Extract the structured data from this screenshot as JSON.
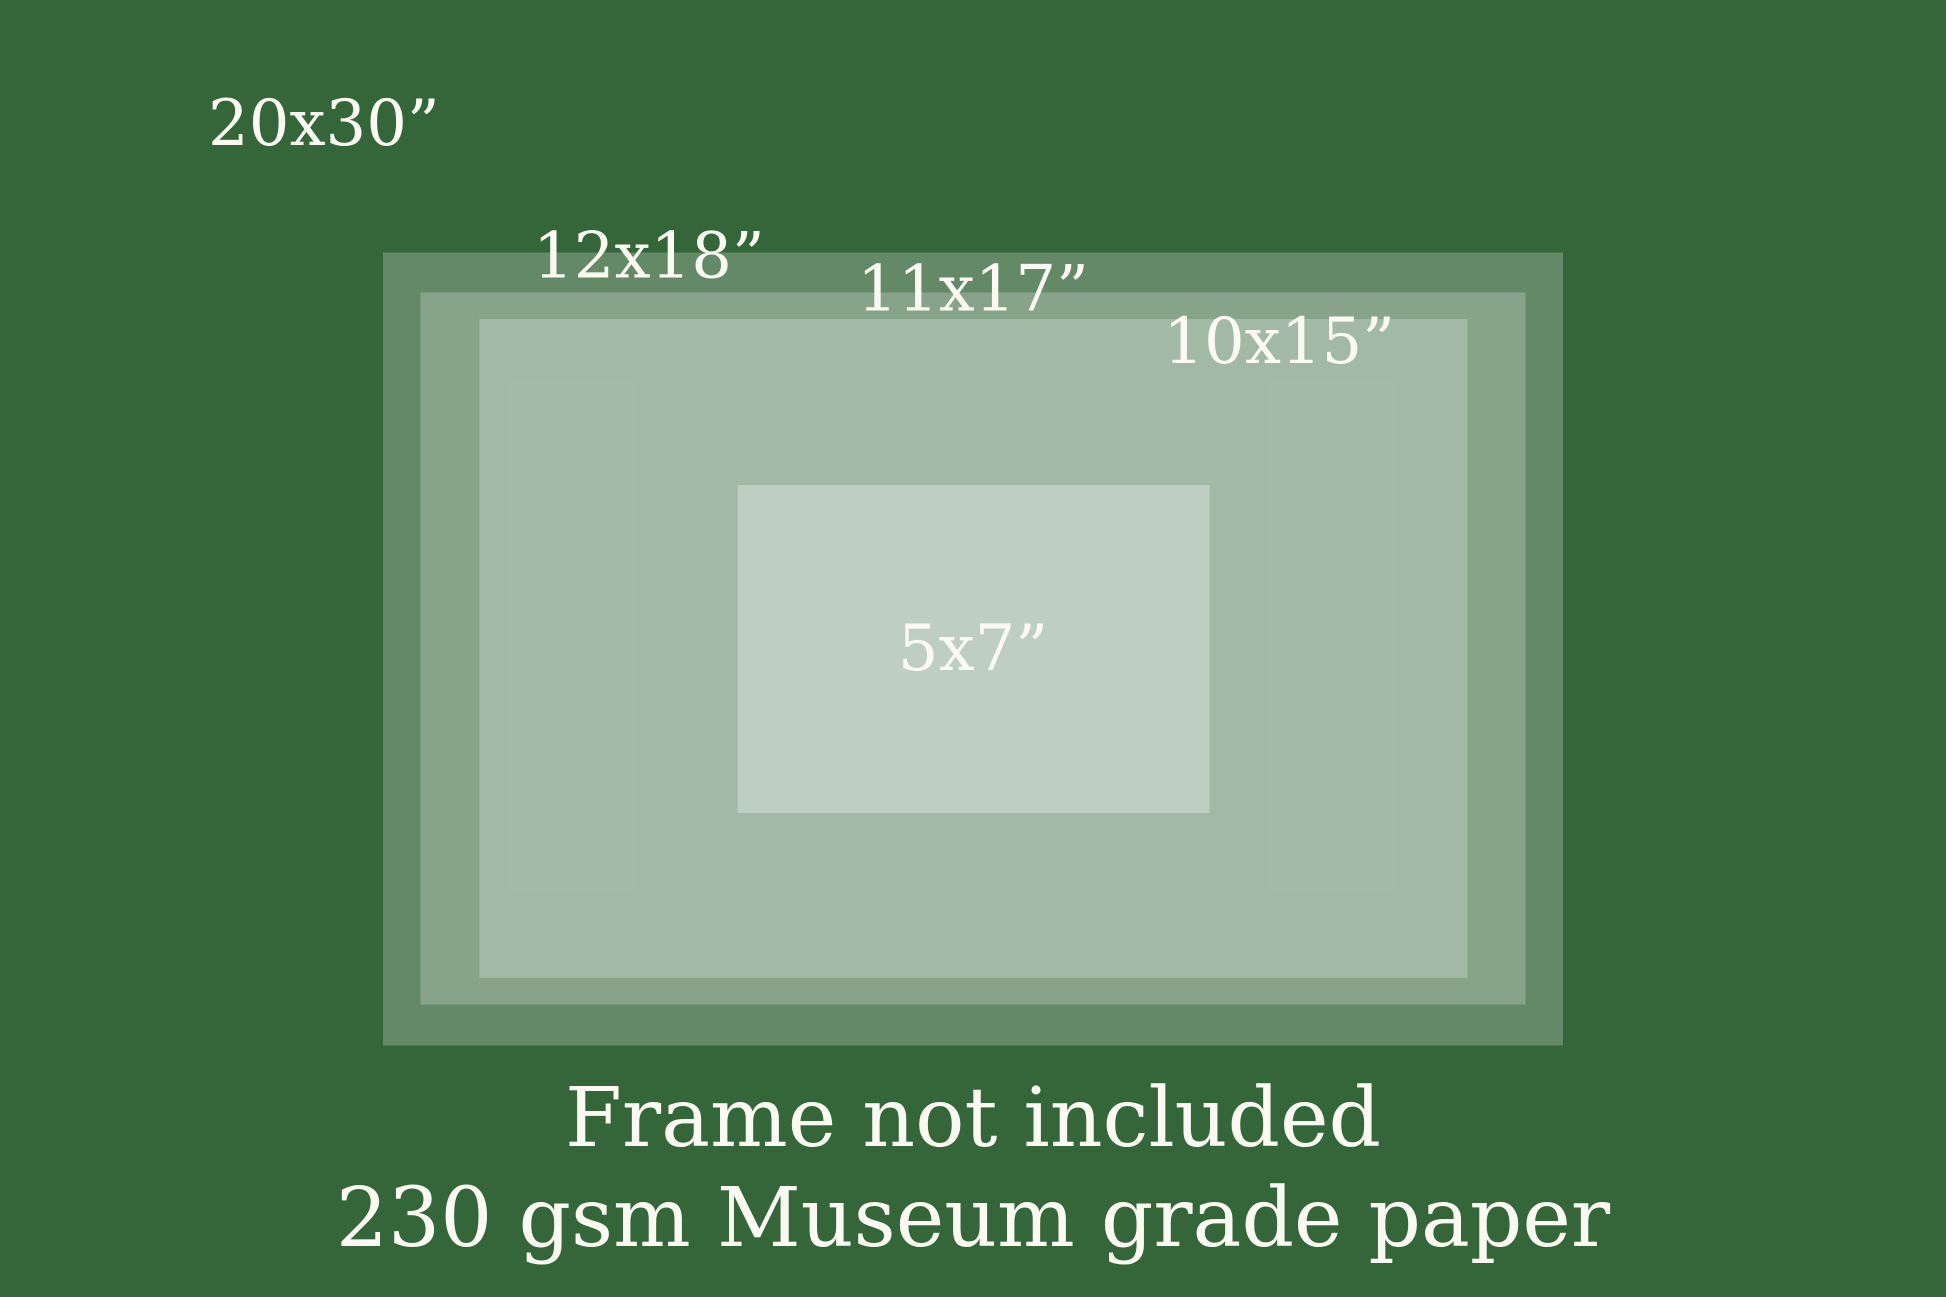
{
  "diagram": {
    "background_size_label": "20x30”",
    "background_color": "#35663A",
    "text_color": "#FAFAF2",
    "overlay_color": "rgba(255,255,255,0.23)",
    "sizes": [
      {
        "label": "12x18”",
        "width_in": 18,
        "height_in": 12
      },
      {
        "label": "11x17”",
        "width_in": 17,
        "height_in": 11
      },
      {
        "label": "10x15”",
        "width_in": 15,
        "height_in": 10
      },
      {
        "label": "5x7”",
        "width_in": 7,
        "height_in": 5
      }
    ],
    "caption": {
      "line1": "Frame not included",
      "line2": "230 gsm Museum grade paper"
    }
  }
}
